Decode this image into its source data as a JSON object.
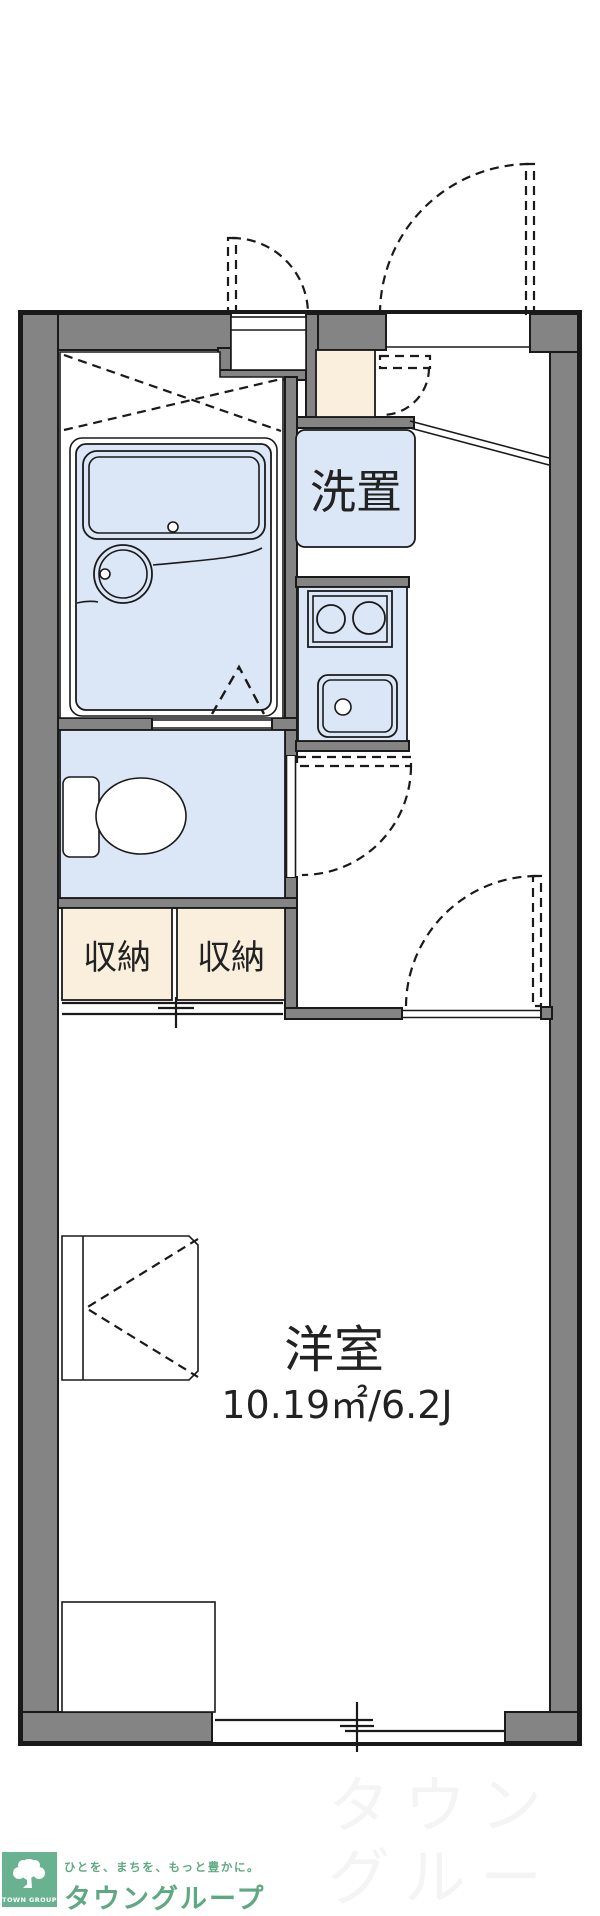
{
  "labels": {
    "washer_storage": "洗置",
    "storage_left": "収納",
    "storage_right": "収納",
    "living_room": "洋室",
    "living_room_area": "10.19㎡/6.2J"
  },
  "footer": {
    "logo_caption": "TOWN GROUP",
    "tagline": "ひとを、まちを、もっと豊かに。",
    "brand_name": "タウングループ",
    "watermark_text": "タウングルー\nタウングルー"
  },
  "colors": {
    "wall": "#848484",
    "line": "#1a1a1a",
    "blue": "#dbe6f7",
    "cream": "#faeedd",
    "brand_green": "#68b291",
    "brand_text": "#5fa982"
  }
}
